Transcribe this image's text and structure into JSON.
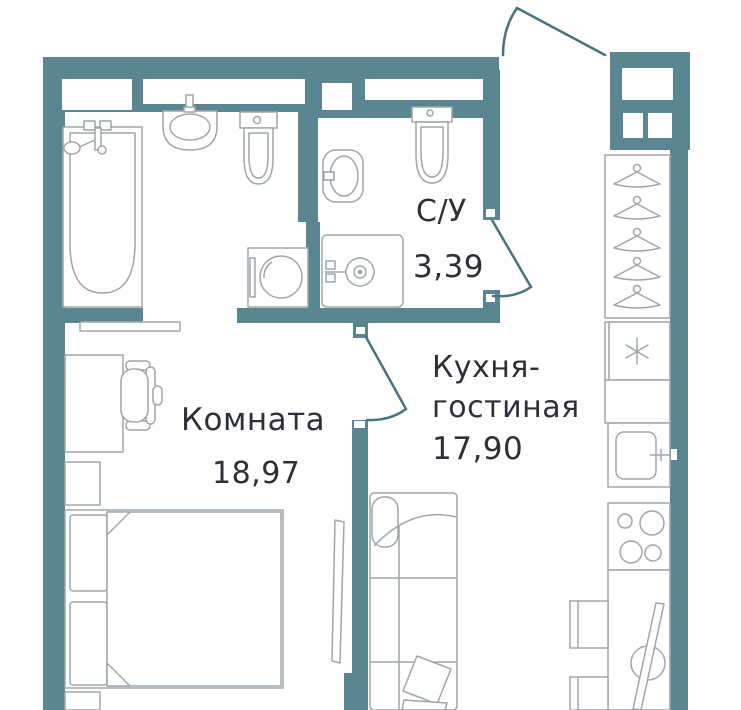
{
  "floorplan": {
    "rooms": [
      {
        "name": "Комната",
        "area": "18,97"
      },
      {
        "name": "С/У",
        "area": "3,39"
      },
      {
        "name": "Кухня-",
        "name2": "гостиная",
        "area": "17,90"
      }
    ],
    "colors": {
      "wall": "#5A8692",
      "furniture_line": "#9FA6AB",
      "door_line": "#47747F",
      "text": "#2D3038",
      "background": "#FFFFFF"
    },
    "fixtures": [
      "bathtub",
      "washbasin",
      "toilet",
      "washing-machine",
      "oval-washbasin",
      "shower-tray",
      "wardrobe-with-hangers",
      "fridge",
      "kitchen-sink",
      "stove-4-burners",
      "kitchen-counter",
      "dining-chairs",
      "ironing-board",
      "sofa",
      "pillows",
      "tv",
      "sliding-door",
      "desk",
      "office-chair",
      "nightstand",
      "double-bed"
    ]
  }
}
